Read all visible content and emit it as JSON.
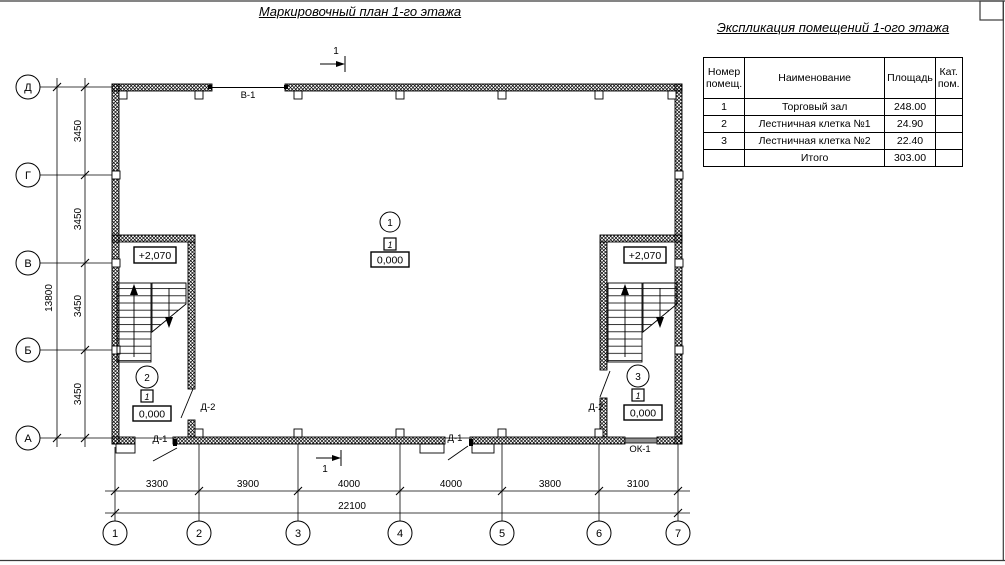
{
  "page": {
    "title": "Маркировочный план 1-го этажа"
  },
  "explication": {
    "title": "Экспликация помещений 1-ого этажа",
    "headers": {
      "num": "Номер помещ.",
      "name": "Наименование",
      "area": "Площадь",
      "cat": "Кат. пом."
    },
    "rows": [
      {
        "num": "1",
        "name": "Торговый зал",
        "area": "248.00",
        "cat": ""
      },
      {
        "num": "2",
        "name": "Лестничная клетка №1",
        "area": "24.90",
        "cat": ""
      },
      {
        "num": "3",
        "name": "Лестничная клетка №2",
        "area": "22.40",
        "cat": ""
      }
    ],
    "total": {
      "label": "Итого",
      "value": "303.00"
    }
  },
  "axes": {
    "vertical": [
      "Д",
      "Г",
      "В",
      "Б",
      "А"
    ],
    "horizontal": [
      "1",
      "2",
      "3",
      "4",
      "5",
      "6",
      "7"
    ]
  },
  "dimensions": {
    "left": {
      "segments": [
        "3450",
        "3450",
        "3450",
        "3450"
      ],
      "total": "13800"
    },
    "bottom": {
      "segments": [
        "3300",
        "3900",
        "4000",
        "4000",
        "3800",
        "3100"
      ],
      "total": "22100"
    }
  },
  "rooms": [
    {
      "number": "1",
      "floor_type": "1",
      "elevation": "0,000"
    },
    {
      "number": "2",
      "floor_type": "1",
      "elevation": "0,000"
    },
    {
      "number": "3",
      "floor_type": "1",
      "elevation": "0,000"
    }
  ],
  "marks": {
    "level_upper": "+2,070",
    "gate": "В-1",
    "door1": "Д-1",
    "door2": "Д-2",
    "window": "ОК-1",
    "section": "1"
  },
  "colors": {
    "line": "#000000",
    "window_fill": "#8f8f8f",
    "frame": "#3a3a3a"
  }
}
